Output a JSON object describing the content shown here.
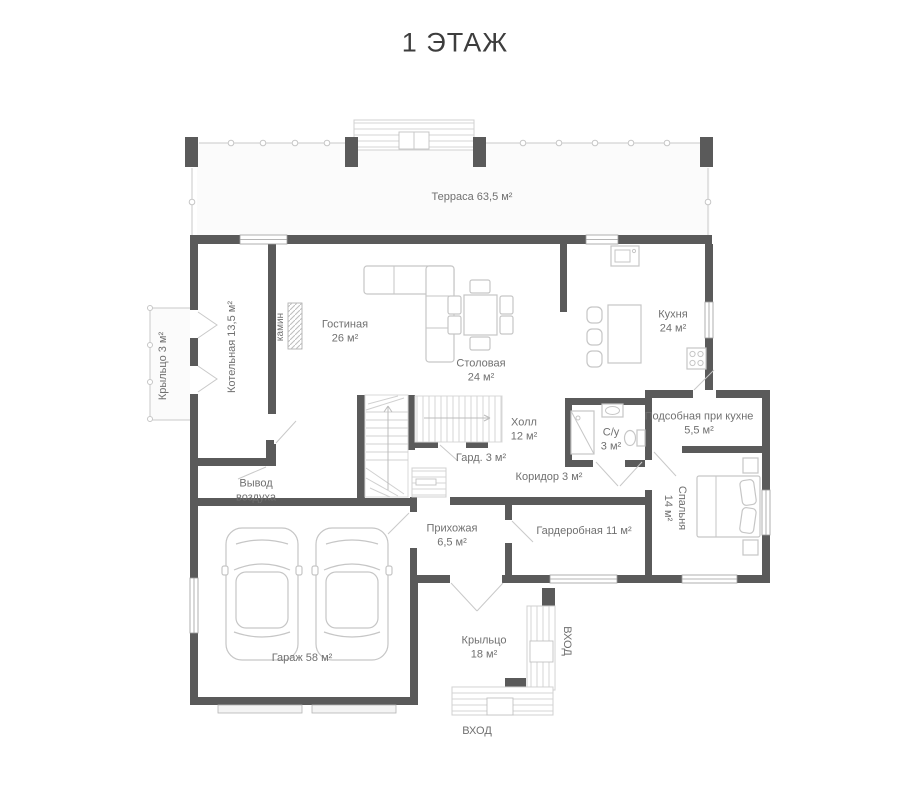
{
  "title": "1 ЭТАЖ",
  "plan": {
    "terrace": "Терраса 63,5 м²",
    "porch_left": "Крыльцо 3 м²",
    "boiler": "Котельная 13,5 м²",
    "fireplace": "камин",
    "living": {
      "name": "Гостиная",
      "area": "26 м²"
    },
    "dining": {
      "name": "Столовая",
      "area": "24 м²"
    },
    "kitchen": {
      "name": "Кухня",
      "area": "24 м²"
    },
    "hall": {
      "name": "Холл",
      "area": "12 м²"
    },
    "closet": "Гард. 3 м²",
    "air_outlet": {
      "line1": "Вывод",
      "line2": "воздуха"
    },
    "bathroom": {
      "name": "С/у",
      "area": "3 м²"
    },
    "corridor": "Коридор 3 м²",
    "pantry": {
      "name": "Подсобная при кухне",
      "area": "5,5 м²"
    },
    "bedroom": {
      "name": "Спальня",
      "area": "14 м²"
    },
    "entry": {
      "name": "Прихожая",
      "area": "6,5 м²"
    },
    "wardrobe": "Гардеробная 11 м²",
    "garage": "Гараж 58 м²",
    "porch_main": {
      "name": "Крыльцо",
      "area": "18 м²"
    },
    "entrance_east": "ВХОД",
    "entrance_south": "ВХОД"
  },
  "colors": {
    "wall": "#5a5a5a",
    "outline": "#c6c6c6",
    "label": "#707070",
    "title": "#3d3d3d"
  }
}
